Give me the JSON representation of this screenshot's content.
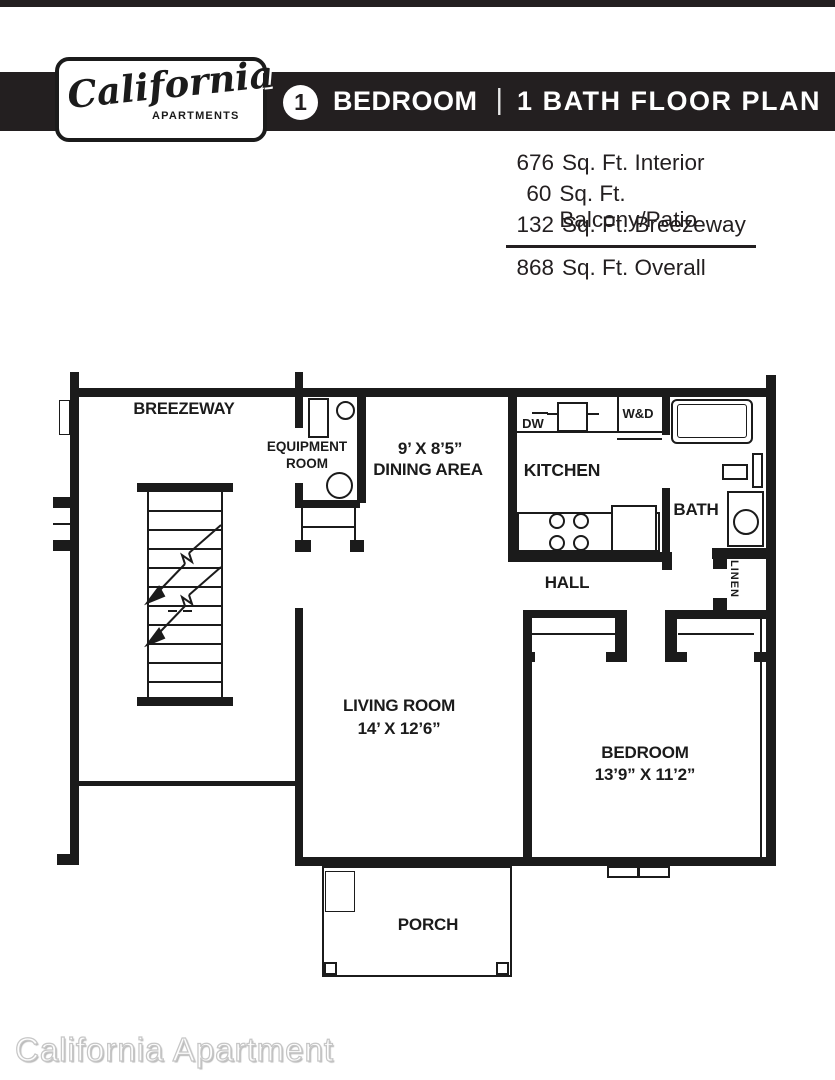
{
  "header": {
    "logo": {
      "brand": "California",
      "sub": "APARTMENTS"
    },
    "banner": {
      "unit_number": "1",
      "unit_label": "BEDROOM",
      "separator": "|",
      "plan_label": "1 BATH FLOOR PLAN"
    }
  },
  "area_stats": {
    "lines": [
      {
        "value": "676",
        "label": "Sq. Ft. Interior"
      },
      {
        "value": "60",
        "label": "Sq. Ft. Balcony/Patio"
      },
      {
        "value": "132",
        "label": "Sq. Ft. Breezeway"
      }
    ],
    "total": {
      "value": "868",
      "label": "Sq. Ft. Overall"
    }
  },
  "floorplan": {
    "breezeway": "BREEZEWAY",
    "equipment_room_line1": "EQUIPMENT",
    "equipment_room_line2": "ROOM",
    "dining_dims": "9’ X 8’5”",
    "dining_name": "DINING AREA",
    "kitchen": "KITCHEN",
    "dw": "DW",
    "wd": "W&D",
    "bath": "BATH",
    "linen": "LINEN",
    "hall": "HALL",
    "living_name": "LIVING ROOM",
    "living_dims": "14’ X 12’6”",
    "bedroom_name": "BEDROOM",
    "bedroom_dims": "13’9” X 11’2”",
    "porch": "PORCH"
  },
  "watermark": "California Apartment",
  "colors": {
    "ink": "#1b1b1b",
    "banner": "#231f20",
    "watermark_gray": "#c6c6c6"
  }
}
